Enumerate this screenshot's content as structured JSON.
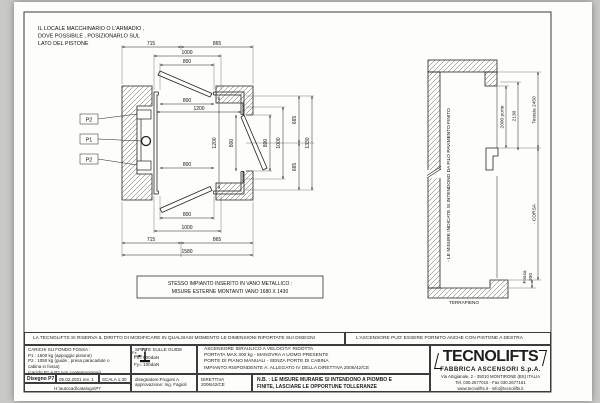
{
  "notes": {
    "machine_room": [
      "IL LOCALE MACCHINARIO O L'ARMADIO ,",
      "DOVE POSSIBILE ,  POSIZIONARLO SUL",
      "LATO DEL PISTONE"
    ],
    "metal_shaft_box": [
      "STESSO IMPIANTO INSERITO IN VANO METALLICO :",
      "MISURE ESTERNE MONTANTI VANO 1680 X 1430"
    ]
  },
  "plan": {
    "labels": {
      "p2a": "P2",
      "p1": "P1",
      "p2b": "P2"
    },
    "top": {
      "d715": "715",
      "d865": "865",
      "d1000": "1000",
      "d800": "800"
    },
    "inner": {
      "top800": "800",
      "top1200": "1200",
      "bot800": "800"
    },
    "vertical": {
      "cab1200": "1200",
      "door800": "800",
      "right800": "800",
      "right1000": "1000",
      "t665": "665",
      "b665": "665",
      "d1330": "1330"
    },
    "bottom": {
      "d800": "800",
      "d1000": "1000",
      "d715": "715",
      "d865": "865",
      "d1580": "1580"
    }
  },
  "section": {
    "wall_note": "- LE MISURE INDICATE SI INTENDONO DA FILO PAVIMENTO FINITO",
    "porte": "2000 porte",
    "d2130": "2130",
    "testata": "Testata 2450",
    "corsa": "- CORSA",
    "fossa": "Fossa",
    "fossa_val": "200",
    "terrapieno": "TERRAPIENO"
  },
  "titleblock": {
    "disclaimer_left": "LA TECNOLIFTS SI RISERVA IL DIRITTO DI MODIFICARE IN QUALSIASI MOMENTO LE DIMENSIONI RIPORTATE SUI DISEGNI",
    "disclaimer_right": "L'ASCENSORE PUO' ESSERE FORNITO ANCHE CON PISTONE A DESTRA",
    "carichi": {
      "title": "CARICHI SU FONDO FOSSA :",
      "l1": "P1 : 1600 kg (appoggio pistone)",
      "l2": "P2 : 1050 kg (guide , presa paracadute o",
      "l3": "cabina in fossa)",
      "l4": "(carichi P1 e P2 non contemporanei)"
    },
    "spinte": {
      "title": "SPINTE SULLE GUIDE",
      "fy": "Fy",
      "fx": "Fx",
      "fx_val": "Fx= 500daN",
      "fy_val": "Fy= 100daN"
    },
    "descr": [
      "ASCENSORE IDRAULICO A VELOCITA' RIDOTTA",
      "PORTATA MAX 300 kg - MANOVRA A UOMO PRESENTE",
      "PORTE DI PIANO MANUALI - SENZA PORTE DI CABINA",
      "IMPIANTO RISPONDENTE A: ALLEGATO IV DELLA DIRETTIVA 2006/42/CE"
    ],
    "drawing_no": "Disegno P7",
    "date": "05.02.2021 rev. 1",
    "scale": "SCALA 1:30",
    "file_path": "H:\\autocad\\catalogo\\P7",
    "drafter": "disegnatore:Frugoni A.",
    "approver": "approvazione: Ing. Fagioli",
    "directive1": "DIRETTIVA",
    "directive2": "2006/42/CE",
    "nb1": "N.B. : LE MISURE MURARIE SI INTENDONO A PIOMBO E",
    "nb2": "FINITE, LASCIARE LE OPPORTUNE TOLLERANZE",
    "logo": {
      "name": "TECNOLIFTS",
      "sub": "FABBRICA ASCENSORI S.p.A.",
      "addr1": "Via Artigianale, 2 - 25010 MONTIRONE (BS) ITALIA",
      "addr2": "Tel. 030.2677016 - Fax 030.2677161",
      "addr3": "www.tecnolifts.it - info@tecnolifts.it"
    }
  }
}
